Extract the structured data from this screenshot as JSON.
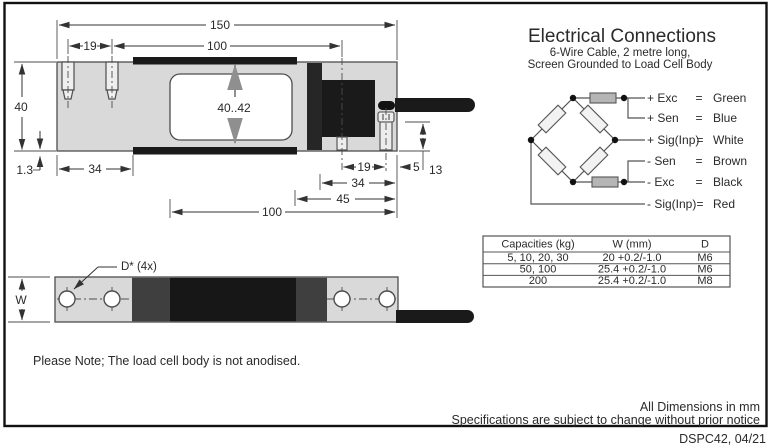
{
  "frame": {
    "code_label": "DSPC42, 04/21"
  },
  "notes": {
    "body_note": "Please Note; The load cell body is not anodised.",
    "dims_note": "All Dimensions in mm",
    "spec_note": "Specifications are subject to change without prior notice"
  },
  "electrical": {
    "title": "Electrical Connections",
    "subtitle_line1": "6-Wire Cable, 2 metre long,",
    "subtitle_line2": "Screen Grounded to Load Cell Body",
    "connections": [
      {
        "signal": "+ Exc",
        "eq": "=",
        "wire": "Green"
      },
      {
        "signal": "+ Sen",
        "eq": "=",
        "wire": "Blue"
      },
      {
        "signal": "+ Sig(Inp)",
        "eq": "=",
        "wire": "White"
      },
      {
        "signal": "- Sen",
        "eq": "=",
        "wire": "Brown"
      },
      {
        "signal": "- Exc",
        "eq": "=",
        "wire": "Black"
      },
      {
        "signal": "- Sig(Inp)",
        "eq": "=",
        "wire": "Red"
      }
    ]
  },
  "capacity_table": {
    "headers": [
      "Capacities (kg)",
      "W (mm)",
      "D"
    ],
    "rows": [
      [
        "5, 10, 20, 30",
        "20 +0.2/-1.0",
        "M6"
      ],
      [
        "50, 100",
        "25.4 +0.2/-1.0",
        "M6"
      ],
      [
        "200",
        "25.4 +0.2/-1.0",
        "M8"
      ]
    ]
  },
  "dims": {
    "d150": "150",
    "d19_left": "19",
    "d100_top": "100",
    "d40": "40",
    "d1_3": "1.3",
    "d34_left": "34",
    "d40_42": "40..42",
    "d19_right": "19",
    "d34_right": "34",
    "d45": "45",
    "d100_bottom": "100",
    "d5": "5",
    "d13": "13",
    "w_label": "W",
    "hole_callout": "D* (4x)"
  },
  "colors": {
    "body_gray": "#d9d9d9",
    "black_part": "#1a1a1a",
    "dark_gray": "#3f3f3f",
    "line": "#4d4d4d"
  }
}
